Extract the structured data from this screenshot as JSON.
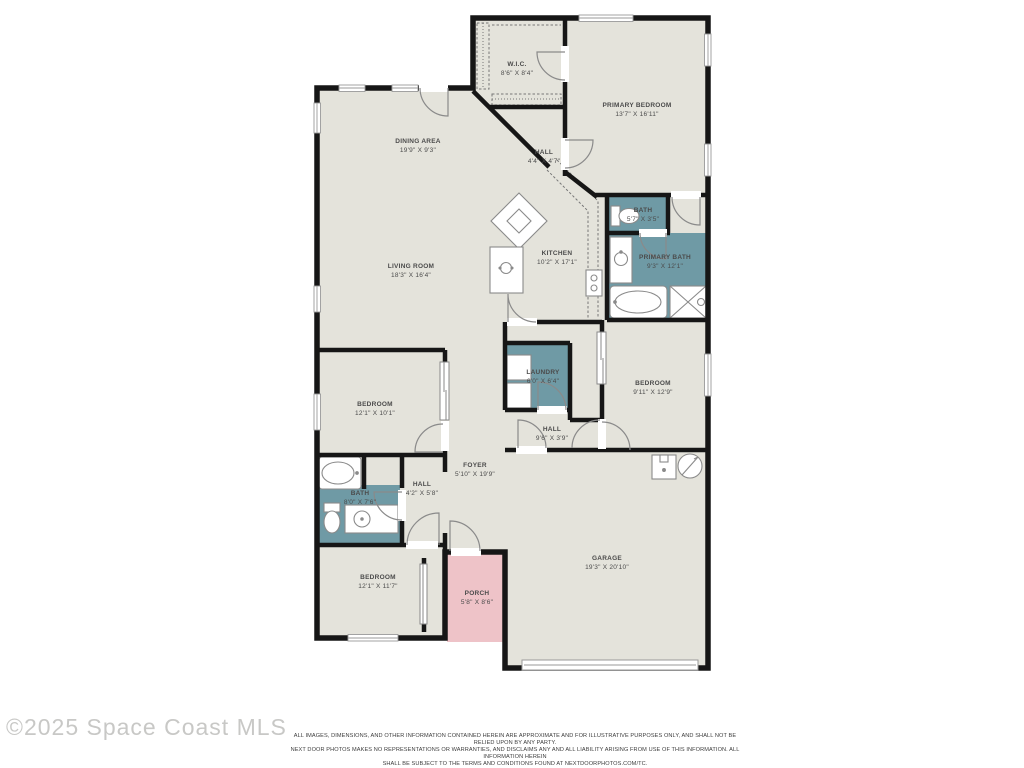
{
  "watermark": {
    "text": "©2025 Space Coast MLS"
  },
  "disclaimer": {
    "line1": "ALL IMAGES, DIMENSIONS, AND OTHER INFORMATION CONTAINED HEREIN ARE APPROXIMATE AND FOR ILLUSTRATIVE PURPOSES ONLY, AND SHALL NOT BE RELIED UPON BY ANY PARTY.",
    "line2": "NEXT DOOR PHOTOS MAKES NO REPRESENTATIONS OR WARRANTIES, AND DISCLAIMS ANY AND ALL LIABILITY ARISING FROM USE OF THIS INFORMATION. ALL INFORMATION HEREIN",
    "line3": "SHALL BE SUBJECT TO THE TERMS AND CONDITIONS FOUND AT NEXTDOORPHOTOS.COM/TC."
  },
  "colors": {
    "floor": "#e4e3db",
    "wet_room": "#6f9aa5",
    "porch": "#eec3c8",
    "wall": "#161616",
    "fixture_stroke": "#8a8a8a"
  },
  "floorplan": {
    "rooms": [
      {
        "id": "wic",
        "name": "W.I.C.",
        "dims": "8'6\" X 8'4\"",
        "x": 517,
        "y": 60
      },
      {
        "id": "primary-bedroom",
        "name": "PRIMARY BEDROOM",
        "dims": "13'7\" X 16'11\"",
        "x": 637,
        "y": 101
      },
      {
        "id": "dining-area",
        "name": "DINING AREA",
        "dims": "19'9\" X 9'3\"",
        "x": 418,
        "y": 137
      },
      {
        "id": "hall-1",
        "name": "HALL",
        "dims": "4'4\" X 4'7\"",
        "x": 544,
        "y": 148
      },
      {
        "id": "bath-1",
        "name": "BATH",
        "dims": "5'7\" X 3'5\"",
        "x": 643,
        "y": 206
      },
      {
        "id": "kitchen",
        "name": "KITCHEN",
        "dims": "10'2\" X 17'1\"",
        "x": 557,
        "y": 249
      },
      {
        "id": "primary-bath",
        "name": "PRIMARY BATH",
        "dims": "9'3\" X 12'1\"",
        "x": 665,
        "y": 253
      },
      {
        "id": "living-room",
        "name": "LIVING ROOM",
        "dims": "18'3\" X 16'4\"",
        "x": 411,
        "y": 262
      },
      {
        "id": "laundry",
        "name": "LAUNDRY",
        "dims": "6'0\" X 6'4\"",
        "x": 543,
        "y": 368
      },
      {
        "id": "bedroom-2",
        "name": "BEDROOM",
        "dims": "9'11\" X 12'9\"",
        "x": 653,
        "y": 379
      },
      {
        "id": "bedroom-1",
        "name": "BEDROOM",
        "dims": "12'1\" X 10'1\"",
        "x": 375,
        "y": 400
      },
      {
        "id": "hall-2",
        "name": "HALL",
        "dims": "9'6\" X 3'9\"",
        "x": 552,
        "y": 425
      },
      {
        "id": "foyer",
        "name": "FOYER",
        "dims": "5'10\" X 19'9\"",
        "x": 475,
        "y": 461
      },
      {
        "id": "hall-3",
        "name": "HALL",
        "dims": "4'2\" X 5'8\"",
        "x": 422,
        "y": 480
      },
      {
        "id": "bath-2",
        "name": "BATH",
        "dims": "8'0\" X 7'6\"",
        "x": 360,
        "y": 489
      },
      {
        "id": "garage",
        "name": "GARAGE",
        "dims": "19'3\" X 20'10\"",
        "x": 607,
        "y": 554
      },
      {
        "id": "bedroom-3",
        "name": "BEDROOM",
        "dims": "12'1\" X 11'7\"",
        "x": 378,
        "y": 573
      },
      {
        "id": "porch",
        "name": "PORCH",
        "dims": "5'8\" X 8'6\"",
        "x": 477,
        "y": 589
      }
    ]
  }
}
